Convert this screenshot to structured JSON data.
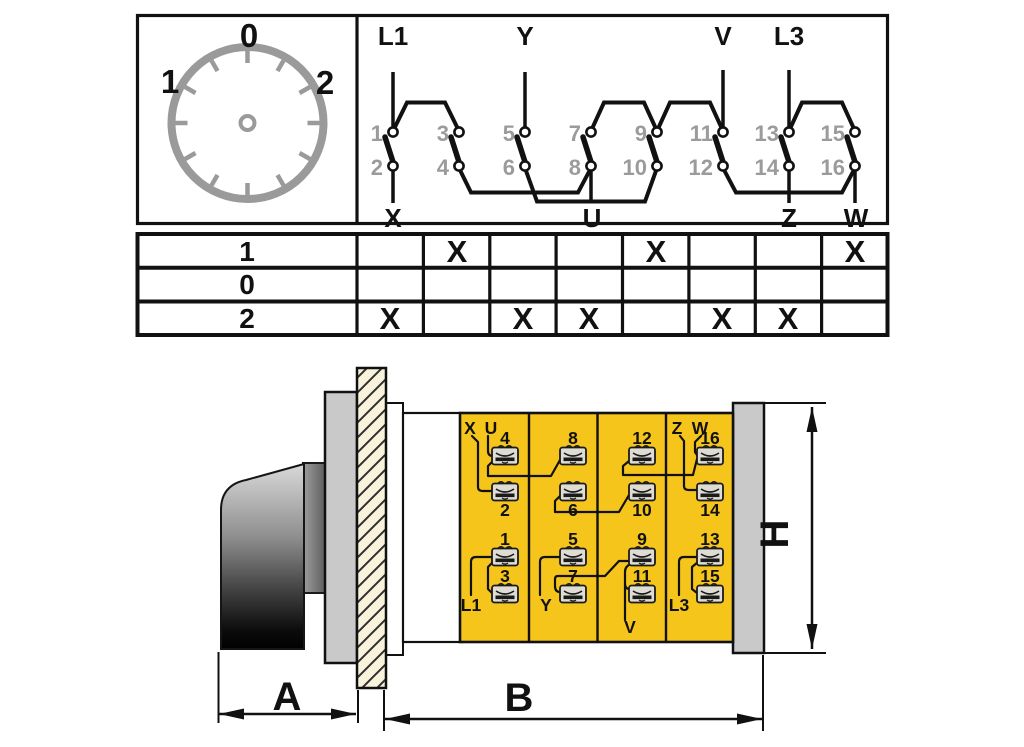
{
  "dial": {
    "labels": [
      "0",
      "1",
      "2"
    ]
  },
  "schematic": {
    "line_terminals_top": [
      "L1",
      "Y",
      "V",
      "L3"
    ],
    "motor_terminals_bottom": [
      "X",
      "U",
      "Z",
      "W"
    ],
    "contact_numbers_top": [
      "1",
      "3",
      "5",
      "7",
      "9",
      "11",
      "13",
      "15"
    ],
    "contact_numbers_bottom": [
      "2",
      "4",
      "6",
      "8",
      "10",
      "12",
      "14",
      "16"
    ],
    "bridges_top": [
      "1-3",
      "7-9",
      "9-11",
      "13-15"
    ],
    "links_bottom": [
      "4-8",
      "6-10",
      "12-16"
    ]
  },
  "table": {
    "rows": [
      {
        "label": "1",
        "cells": [
          "",
          "X",
          "",
          "",
          "X",
          "",
          "",
          "X"
        ]
      },
      {
        "label": "0",
        "cells": [
          "",
          "",
          "",
          "",
          "",
          "",
          "",
          ""
        ]
      },
      {
        "label": "2",
        "cells": [
          "X",
          "",
          "X",
          "X",
          "",
          "X",
          "X",
          ""
        ]
      }
    ]
  },
  "terminal_block": {
    "columns": [
      {
        "top_numbers": [
          "4",
          "2"
        ],
        "top_labels": [
          "X",
          "U"
        ],
        "bottom_numbers": [
          "1",
          "3"
        ],
        "bottom_label": "L1"
      },
      {
        "top_numbers": [
          "8",
          "6"
        ],
        "top_labels": [],
        "bottom_numbers": [
          "5",
          "7"
        ],
        "bottom_label": "Y"
      },
      {
        "top_numbers": [
          "12",
          "10"
        ],
        "top_labels": [],
        "bottom_numbers": [
          "9",
          "11"
        ],
        "bottom_label": "V"
      },
      {
        "top_numbers": [
          "16",
          "14"
        ],
        "top_labels": [
          "Z",
          "W"
        ],
        "bottom_numbers": [
          "13",
          "15"
        ],
        "bottom_label": "L3"
      }
    ]
  },
  "dimensions": {
    "a": "A",
    "b": "B",
    "h": "H"
  },
  "colors": {
    "ink": "#111111",
    "gray-num": "#9b9b9b",
    "dial-gray": "#9a9a9a",
    "block-yellow": "#f6c51b",
    "plate-gray": "#c9c9c9",
    "hatch-cream": "#f8f3da",
    "terminal-face": "#dedcd3"
  }
}
